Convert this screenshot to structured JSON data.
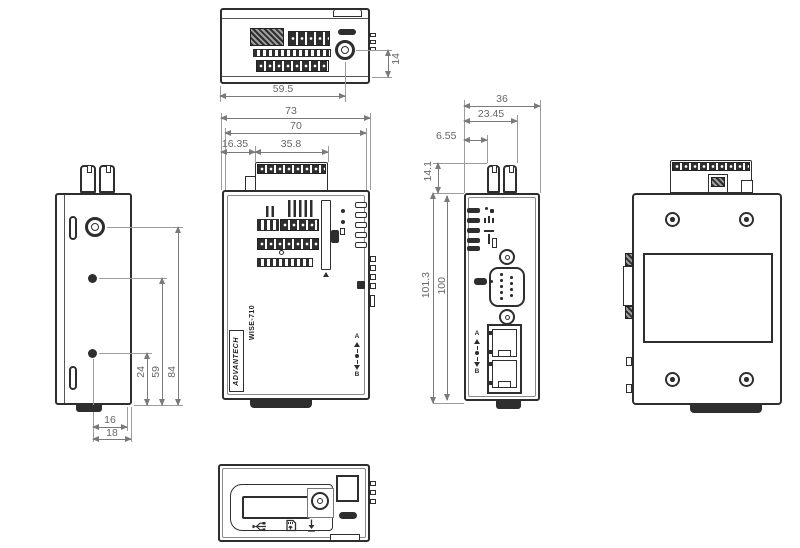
{
  "brand": "ADVANTECH",
  "model": "WISE-710",
  "colors": {
    "line": "#2e2e2e",
    "dim_line": "#7a7a7a",
    "dim_text": "#666666"
  },
  "views": {
    "top": {
      "dim_width_to_antenna": "59.5",
      "dim_antenna_offset": "14"
    },
    "front": {
      "dim_overall_width": "73",
      "dim_body_width": "70",
      "dim_terminal_left_offset": "16.35",
      "dim_terminal_width": "35.8",
      "label_switch_a": "A",
      "label_switch_b": "B"
    },
    "side": {
      "dim_overall_depth": "36",
      "dim_connector_depth": "23.45",
      "dim_connector_offset": "6.55",
      "dim_terminal_height": "14.1",
      "dim_overall_height": "101.3",
      "dim_body_height": "100",
      "label_port_a": "A",
      "label_port_b": "B"
    },
    "left": {
      "dim_antenna_height": "84",
      "dim_hole_mid_height": "59",
      "dim_hole_low_height": "24",
      "dim_hole_to_edge_inner": "16",
      "dim_hole_to_edge_outer": "18"
    }
  }
}
